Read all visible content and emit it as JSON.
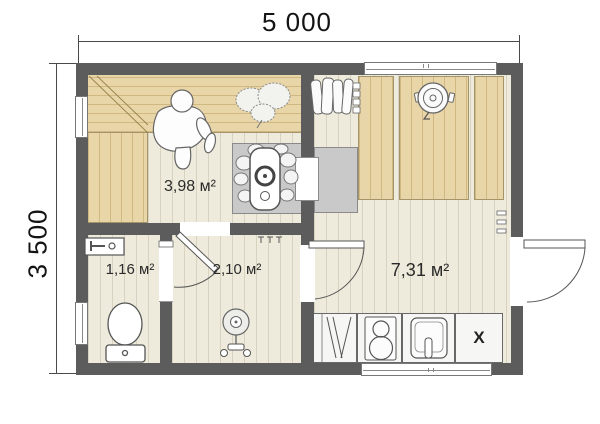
{
  "drawing": {
    "dimensions": {
      "width": "5 000",
      "height": "3 500"
    },
    "rooms": {
      "sauna": {
        "label": "3,98 м²"
      },
      "wc": {
        "label": "1,16 м²"
      },
      "shower": {
        "label": "2,10 м²"
      },
      "rest": {
        "label": "7,31 м²"
      }
    },
    "kitchen": {
      "cabinet_x": "X"
    },
    "colors": {
      "wall": "#5c5c5c",
      "floor": "#efebdc",
      "wood": "#e9d6a8",
      "platform": "#c9c9c9"
    }
  }
}
